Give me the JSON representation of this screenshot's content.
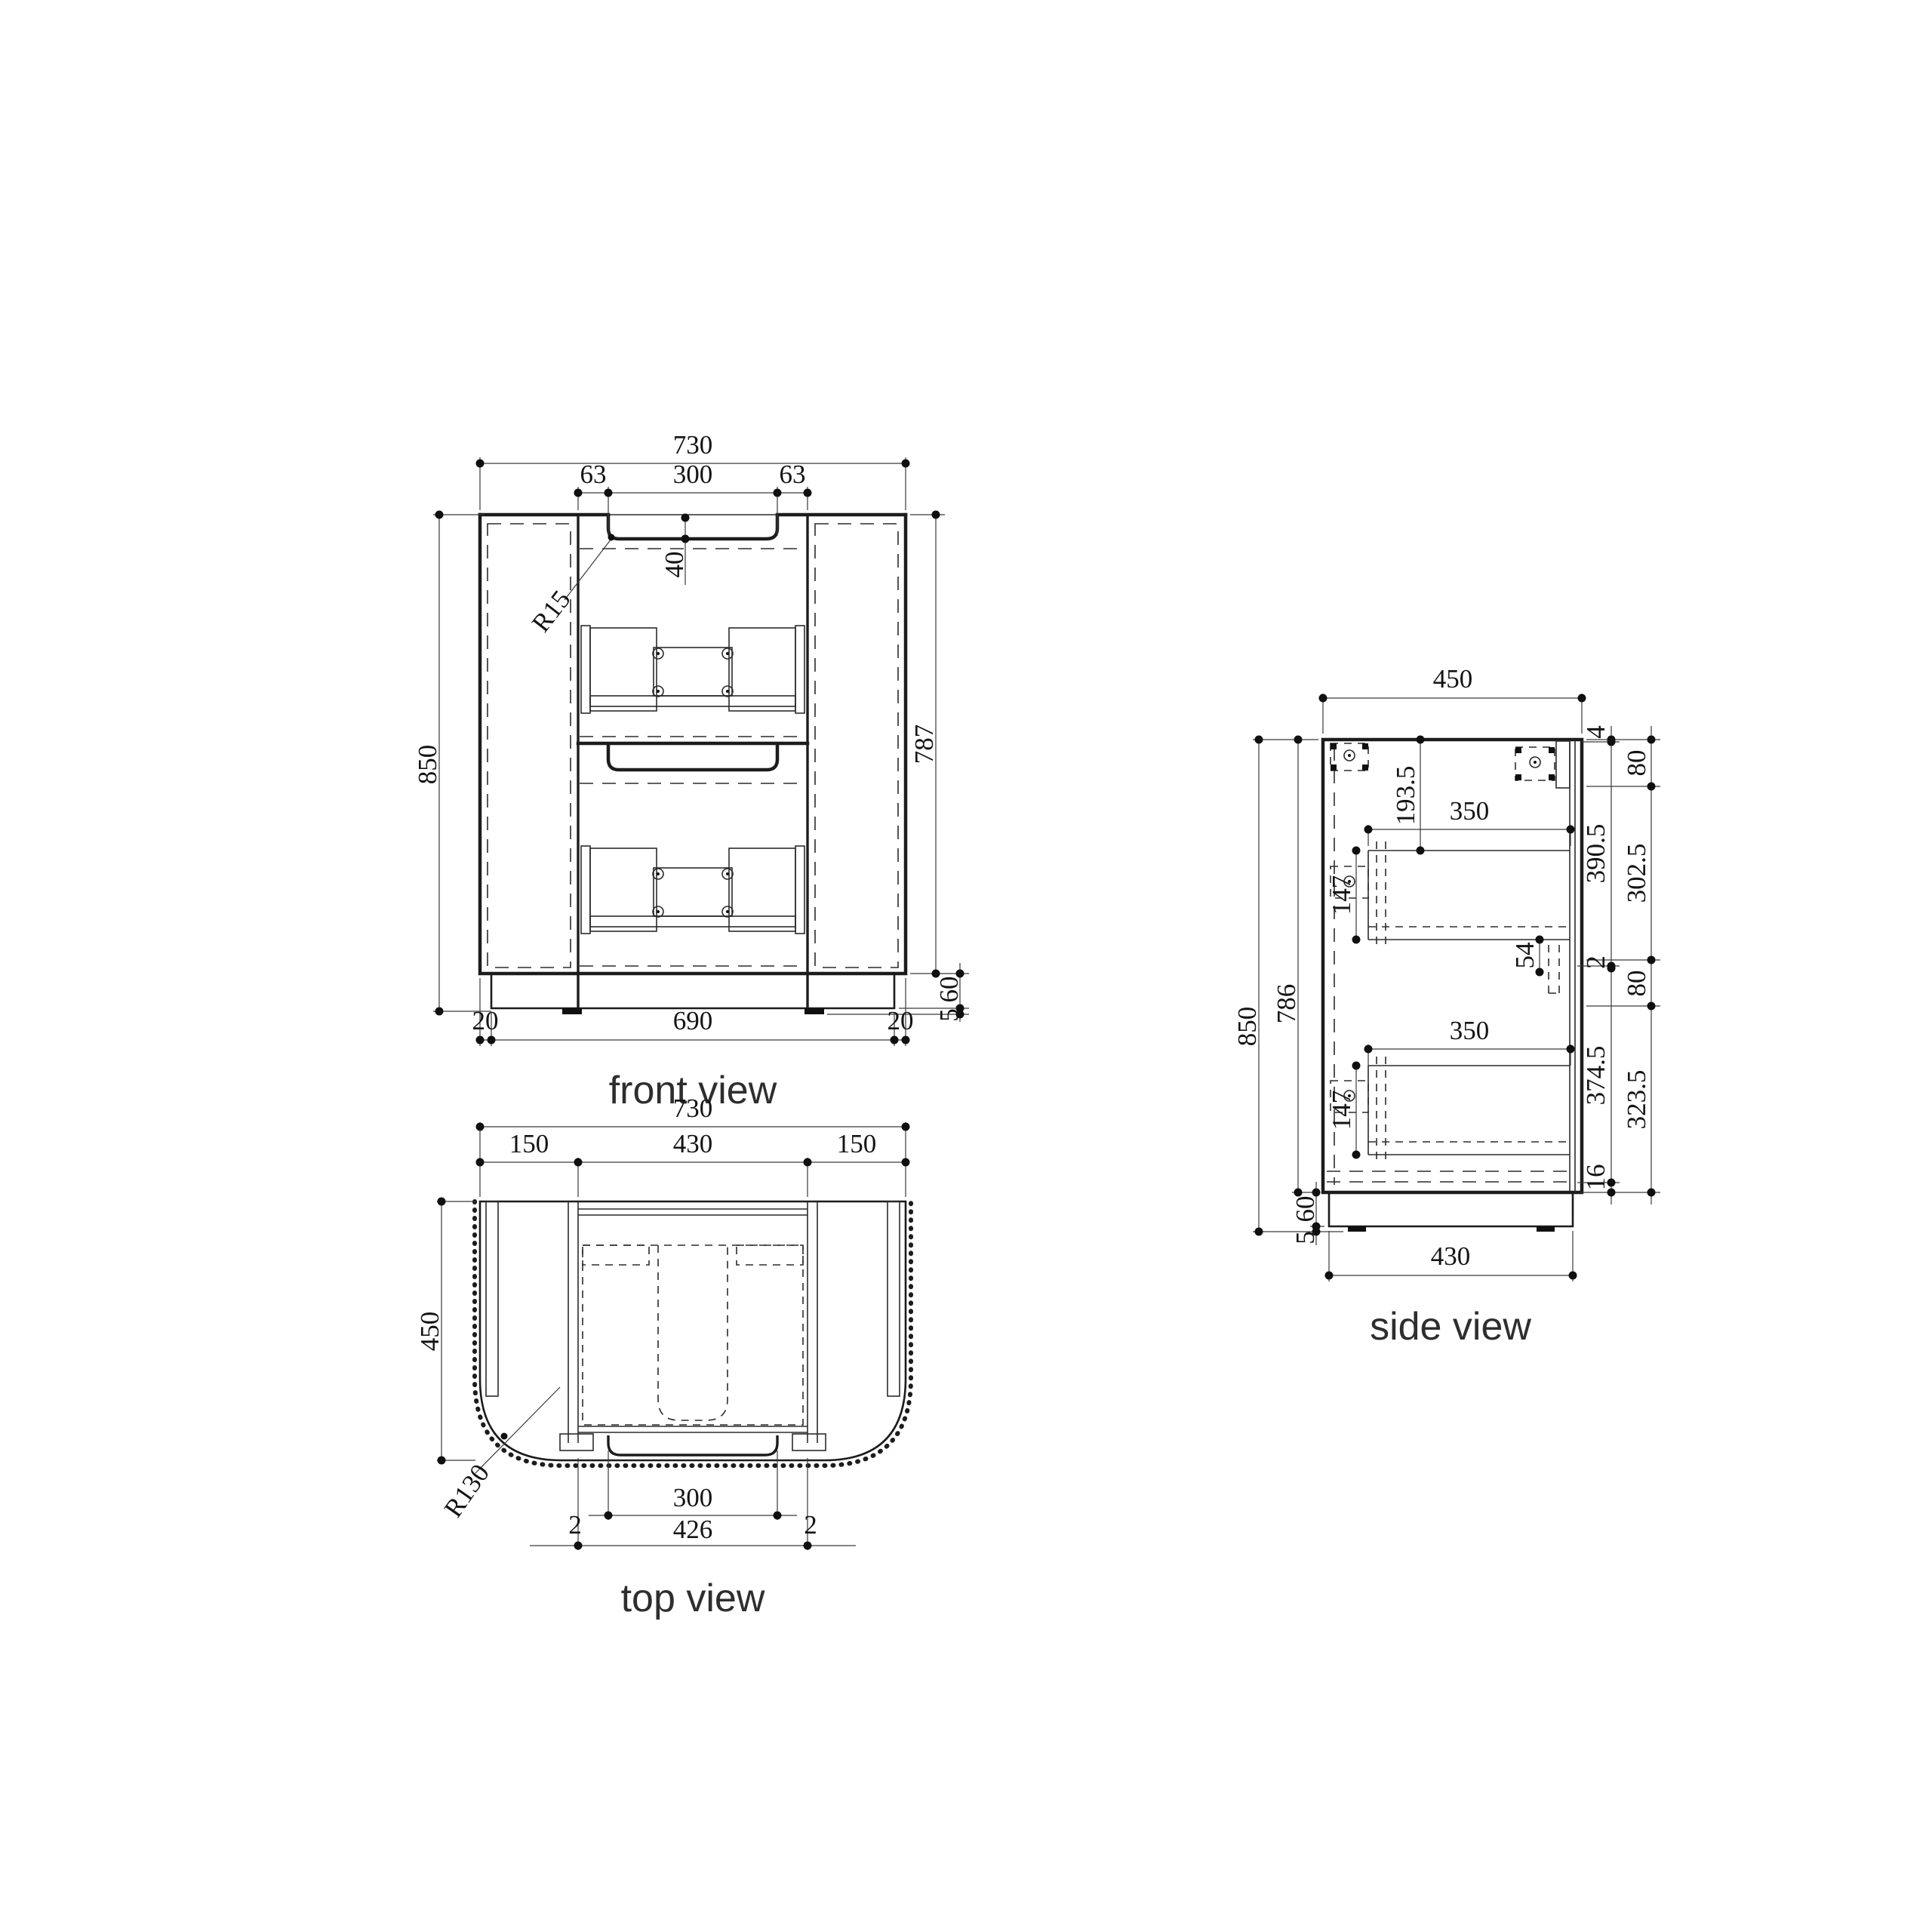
{
  "drawing": {
    "background": "#ffffff",
    "line_color": "#1c1c1c",
    "text_color": "#141414"
  },
  "views": {
    "front": {
      "title": "front view",
      "dims": {
        "overall_width": "730",
        "recess_offset_left": "63",
        "recess_width": "300",
        "recess_offset_right": "63",
        "recess_depth": "40",
        "recess_radius": "R15",
        "overall_height": "850",
        "body_height": "787",
        "plinth_height": "60",
        "feet_height": "5",
        "base_inset_left": "20",
        "base_width": "690",
        "base_inset_right": "20"
      }
    },
    "top": {
      "title": "top view",
      "dims": {
        "overall_width": "730",
        "side_panel_left": "150",
        "center_width": "430",
        "side_panel_right": "150",
        "depth": "450",
        "corner_radius": "R130",
        "front_lip_width": "300",
        "drawer_width": "426",
        "clearance_left": "2",
        "clearance_right": "2"
      }
    },
    "side": {
      "title": "side view",
      "dims": {
        "top_depth": "450",
        "overall_height": "850",
        "body_height": "786",
        "plinth_height": "60",
        "feet_height": "5",
        "bottom_depth": "430",
        "top_to_drawer1": "193.5",
        "drawer1_depth": "350",
        "drawer1_height": "147",
        "rail_gap": "54",
        "drawer2_depth": "350",
        "drawer2_height": "147",
        "chain_inner": [
          "4",
          "390.5",
          "2",
          "374.5",
          "16"
        ],
        "chain_outer": [
          "80",
          "302.5",
          "80",
          "323.5"
        ]
      }
    }
  }
}
